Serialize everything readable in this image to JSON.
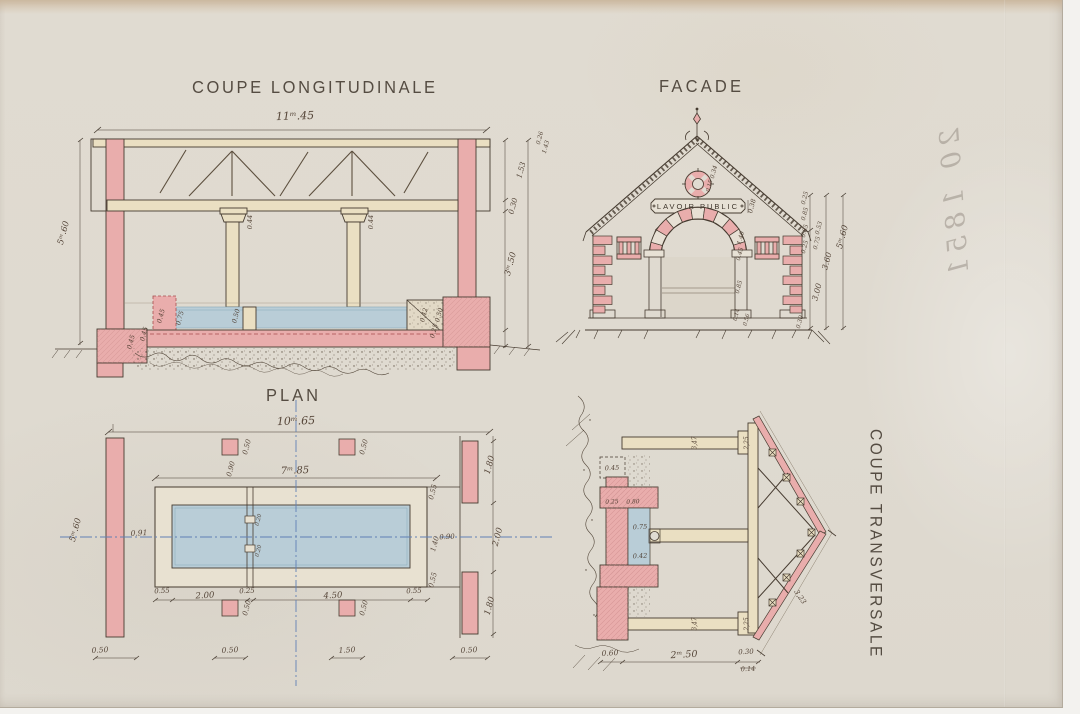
{
  "page": {
    "description": "Scanned 19th-century French architectural drawing of a public wash-house (lavoir public) with four views on aged paper"
  },
  "titles": {
    "longitudinal": "COUPE LONGITUDINALE",
    "facade": "FACADE",
    "plan": "PLAN",
    "transversale": "COUPE TRANSVERSALE"
  },
  "facade_sign": "LAVOIR PUBLIC",
  "handwriting": {
    "note": "20 1851"
  },
  "colors": {
    "paper": "#dfdad0",
    "masonry_pink": "#e9adac",
    "wood_cream": "#eadfc2",
    "water_blue": "#b9cdd7",
    "ink": "#463b30",
    "centerline_blue": "#6080b5",
    "red_dash": "#a84c4c"
  },
  "labels": {
    "longitudinal": [
      {
        "t": "11ᵐ.45",
        "x": 295,
        "y": 116,
        "r": -2,
        "s": 11
      },
      {
        "t": "0.26",
        "x": 540,
        "y": 138,
        "r": -75,
        "s": 6
      },
      {
        "t": "1.43",
        "x": 546,
        "y": 147,
        "r": -75,
        "s": 6
      },
      {
        "t": "1.53",
        "x": 521,
        "y": 170,
        "r": -75,
        "s": 7.5
      },
      {
        "t": "0.30",
        "x": 513,
        "y": 206,
        "r": -75,
        "s": 7.5
      },
      {
        "t": "3ᵐ.50",
        "x": 511,
        "y": 264,
        "r": -75,
        "s": 8.5
      },
      {
        "t": "5ᵐ.60",
        "x": 64,
        "y": 233,
        "r": -75,
        "s": 8.5
      },
      {
        "t": "0.44",
        "x": 250,
        "y": 222,
        "r": -90,
        "s": 6.5
      },
      {
        "t": "0.44",
        "x": 371,
        "y": 222,
        "r": -90,
        "s": 6.5
      },
      {
        "t": "0.45",
        "x": 161,
        "y": 316,
        "r": -75,
        "s": 6.5
      },
      {
        "t": "0.75",
        "x": 180,
        "y": 318,
        "r": -75,
        "s": 6.5
      },
      {
        "t": "0.50",
        "x": 236,
        "y": 316,
        "r": -75,
        "s": 6.5
      },
      {
        "t": "0.42",
        "x": 424,
        "y": 315,
        "r": -75,
        "s": 6.5
      },
      {
        "t": "0.50",
        "x": 439,
        "y": 315,
        "r": -75,
        "s": 6.5
      },
      {
        "t": "0.45",
        "x": 144,
        "y": 334,
        "r": -75,
        "s": 6.5
      },
      {
        "t": "0.25",
        "x": 434,
        "y": 331,
        "r": -75,
        "s": 6.5
      },
      {
        "t": "0.45",
        "x": 131,
        "y": 342,
        "r": -75,
        "s": 6.5
      }
    ],
    "facade": [
      {
        "t": "0.34",
        "x": 714,
        "y": 172,
        "r": -75,
        "s": 6
      },
      {
        "t": "0.15",
        "x": 710,
        "y": 186,
        "r": -75,
        "s": 5.5
      },
      {
        "t": "0.38",
        "x": 752,
        "y": 206,
        "r": -75,
        "s": 6.5
      },
      {
        "t": "1.40",
        "x": 741,
        "y": 238,
        "r": -75,
        "s": 6
      },
      {
        "t": "0.45",
        "x": 740,
        "y": 254,
        "r": -75,
        "s": 6
      },
      {
        "t": "0.85",
        "x": 739,
        "y": 287,
        "r": -75,
        "s": 6
      },
      {
        "t": "0.14",
        "x": 737,
        "y": 315,
        "r": -75,
        "s": 5.5
      },
      {
        "t": "0.56",
        "x": 747,
        "y": 320,
        "r": -75,
        "s": 5.5
      },
      {
        "t": "0.25",
        "x": 805,
        "y": 198,
        "r": -75,
        "s": 6
      },
      {
        "t": "0.85",
        "x": 805,
        "y": 214,
        "r": -75,
        "s": 6
      },
      {
        "t": "0.85",
        "x": 805,
        "y": 231,
        "r": -75,
        "s": 6
      },
      {
        "t": "0.25",
        "x": 805,
        "y": 247,
        "r": -75,
        "s": 6
      },
      {
        "t": "0.53",
        "x": 819,
        "y": 228,
        "r": -75,
        "s": 6
      },
      {
        "t": "0.75",
        "x": 817,
        "y": 243,
        "r": -75,
        "s": 6
      },
      {
        "t": "3.60",
        "x": 827,
        "y": 261,
        "r": -75,
        "s": 8
      },
      {
        "t": "3.00",
        "x": 817,
        "y": 292,
        "r": -75,
        "s": 8
      },
      {
        "t": "5ᵐ.60",
        "x": 843,
        "y": 237,
        "r": -75,
        "s": 8.5
      },
      {
        "t": "0.30",
        "x": 800,
        "y": 322,
        "r": -75,
        "s": 6
      }
    ],
    "plan": [
      {
        "t": "10ᵐ.65",
        "x": 296,
        "y": 421,
        "r": -2,
        "s": 11
      },
      {
        "t": "7ᵐ.85",
        "x": 295,
        "y": 471,
        "r": -2,
        "s": 10
      },
      {
        "t": "5ᵐ.60",
        "x": 76,
        "y": 530,
        "r": -75,
        "s": 8.5
      },
      {
        "t": "0.50",
        "x": 100,
        "y": 650,
        "r": -3,
        "s": 7.5
      },
      {
        "t": "0.50",
        "x": 247,
        "y": 447,
        "r": -75,
        "s": 7
      },
      {
        "t": "0.50",
        "x": 364,
        "y": 447,
        "r": -75,
        "s": 7
      },
      {
        "t": "0.50",
        "x": 247,
        "y": 608,
        "r": -75,
        "s": 7
      },
      {
        "t": "0.50",
        "x": 364,
        "y": 608,
        "r": -75,
        "s": 7
      },
      {
        "t": "0.90",
        "x": 231,
        "y": 469,
        "r": -75,
        "s": 7
      },
      {
        "t": "0.91",
        "x": 139,
        "y": 533,
        "r": -3,
        "s": 7.5
      },
      {
        "t": "0.55",
        "x": 162,
        "y": 591,
        "r": -3,
        "s": 7
      },
      {
        "t": "2.00",
        "x": 205,
        "y": 596,
        "r": -3,
        "s": 8.5
      },
      {
        "t": "0.25",
        "x": 247,
        "y": 591,
        "r": -3,
        "s": 7
      },
      {
        "t": "4.50",
        "x": 333,
        "y": 596,
        "r": -3,
        "s": 8.5
      },
      {
        "t": "0.55",
        "x": 414,
        "y": 591,
        "r": -3,
        "s": 7
      },
      {
        "t": "0.55",
        "x": 433,
        "y": 492,
        "r": -75,
        "s": 7
      },
      {
        "t": "0.55",
        "x": 433,
        "y": 580,
        "r": -75,
        "s": 7
      },
      {
        "t": "1.40",
        "x": 435,
        "y": 544,
        "r": -75,
        "s": 7
      },
      {
        "t": "0.90",
        "x": 447,
        "y": 537,
        "r": -3,
        "s": 7
      },
      {
        "t": "2.00",
        "x": 498,
        "y": 537,
        "r": -75,
        "s": 8.5
      },
      {
        "t": "1.80",
        "x": 490,
        "y": 465,
        "r": -75,
        "s": 8.5
      },
      {
        "t": "1.80",
        "x": 490,
        "y": 606,
        "r": -75,
        "s": 8.5
      },
      {
        "t": "0.50",
        "x": 469,
        "y": 650,
        "r": -3,
        "s": 7.5
      },
      {
        "t": "0.50",
        "x": 230,
        "y": 650,
        "r": -3,
        "s": 7.5
      },
      {
        "t": "1.50",
        "x": 347,
        "y": 650,
        "r": -3,
        "s": 7.5
      },
      {
        "t": "0.20",
        "x": 259,
        "y": 520,
        "r": -75,
        "s": 5.5
      },
      {
        "t": "0.20",
        "x": 259,
        "y": 551,
        "r": -75,
        "s": 5.5
      }
    ],
    "transversale": [
      {
        "t": "0.45",
        "x": 612,
        "y": 468,
        "r": -3,
        "s": 6.5
      },
      {
        "t": "0.25",
        "x": 612,
        "y": 502,
        "r": -3,
        "s": 6
      },
      {
        "t": "0.80",
        "x": 633,
        "y": 502,
        "r": -3,
        "s": 6
      },
      {
        "t": "0.75",
        "x": 640,
        "y": 527,
        "r": -3,
        "s": 6.5
      },
      {
        "t": "0.42",
        "x": 640,
        "y": 556,
        "r": -3,
        "s": 6.5
      },
      {
        "t": "0.60",
        "x": 610,
        "y": 653,
        "r": -3,
        "s": 7.5
      },
      {
        "t": "2ᵐ.50",
        "x": 684,
        "y": 655,
        "r": -3,
        "s": 9.5
      },
      {
        "t": "0.30",
        "x": 746,
        "y": 652,
        "r": -3,
        "s": 7
      },
      {
        "t": "0.14",
        "x": 748,
        "y": 669,
        "r": -3,
        "s": 6.5
      },
      {
        "t": "3,47",
        "x": 695,
        "y": 443,
        "r": -90,
        "s": 6
      },
      {
        "t": "3,47",
        "x": 695,
        "y": 624,
        "r": -90,
        "s": 6
      },
      {
        "t": "2,25",
        "x": 747,
        "y": 443,
        "r": -90,
        "s": 6
      },
      {
        "t": "2,25",
        "x": 747,
        "y": 624,
        "r": -90,
        "s": 6
      },
      {
        "t": "3,23",
        "x": 800,
        "y": 597,
        "r": 56,
        "s": 7
      }
    ]
  }
}
